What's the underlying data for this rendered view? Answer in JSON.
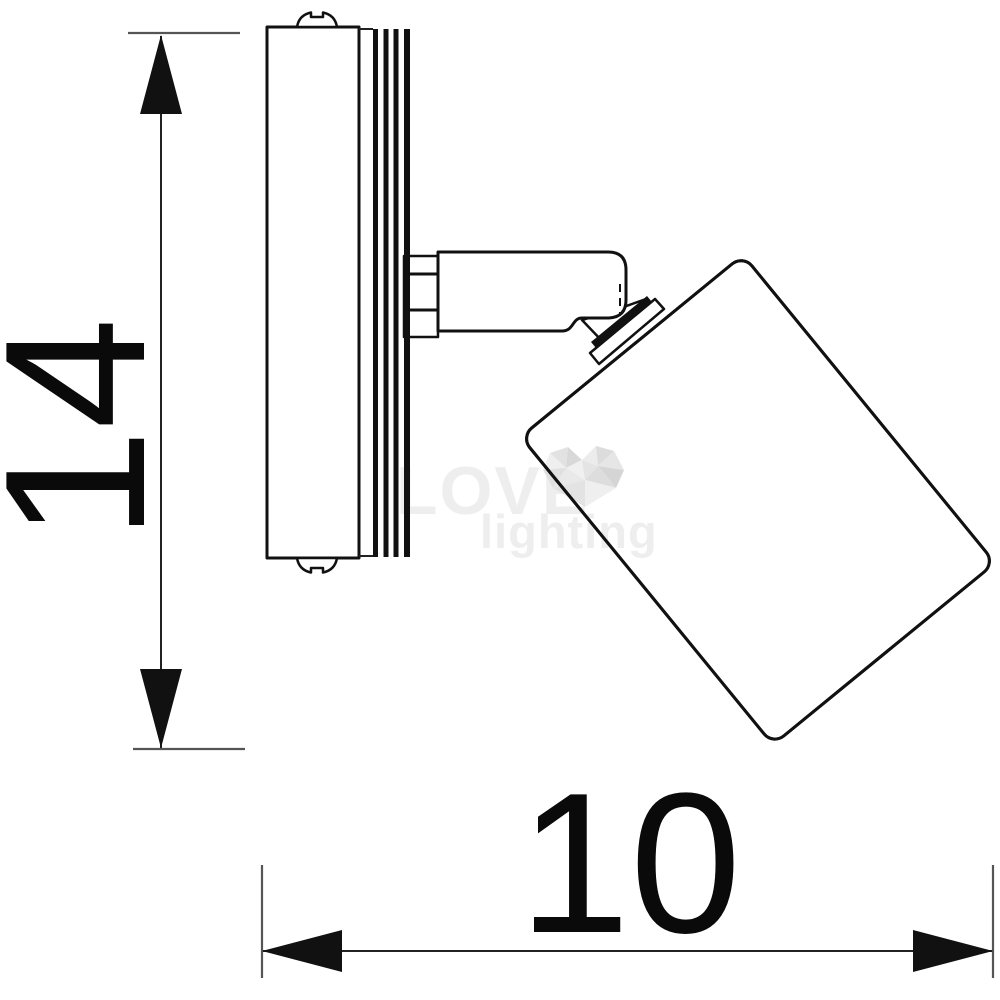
{
  "page": {
    "background_color": "#ffffff"
  },
  "drawing": {
    "line_color": "#111111",
    "dimension_line_color": "#222222",
    "extension_line_color": "#555555",
    "height_dimension": {
      "label": "14"
    },
    "width_dimension": {
      "label": "10"
    }
  },
  "watermark": {
    "word1": "LOVE",
    "word2": "lighting",
    "text_color": "#eeeeee",
    "heart_color": "#e0e0e0"
  }
}
